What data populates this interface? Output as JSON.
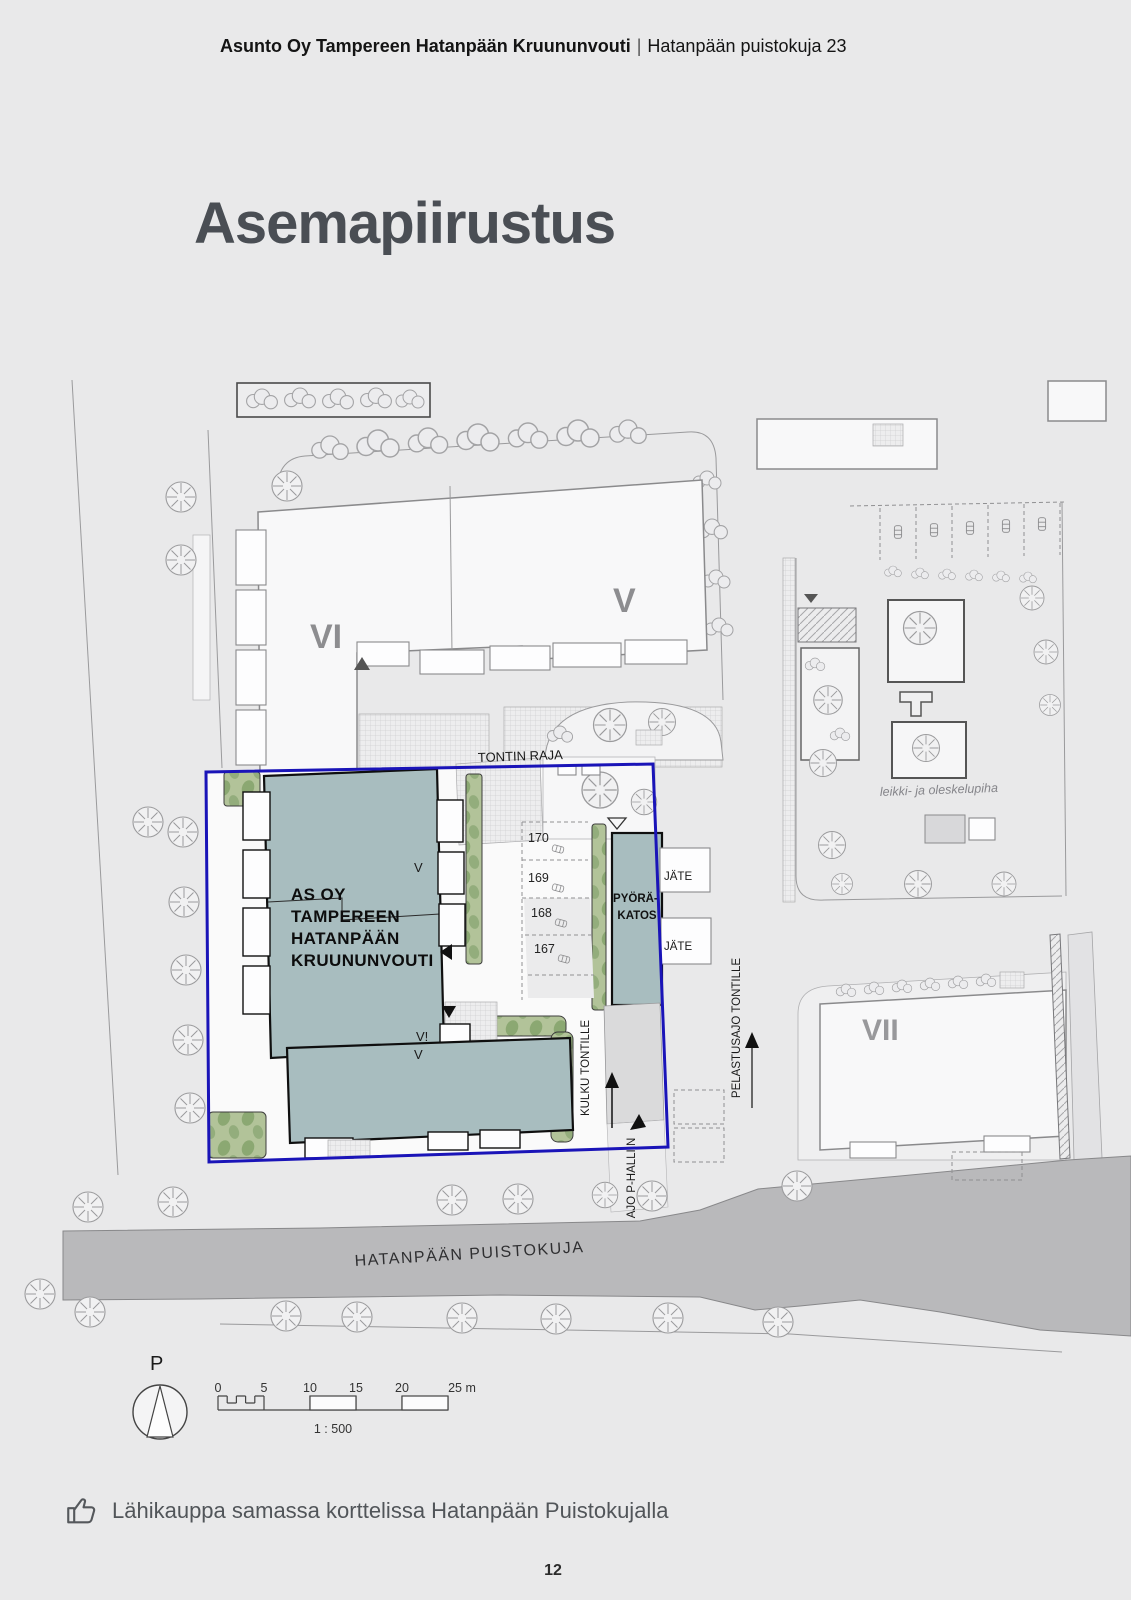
{
  "header": {
    "project": "Asunto Oy Tampereen Hatanpään Kruununvouti",
    "separator": "|",
    "address": "Hatanpään puistokuja 23"
  },
  "title": "Asemapiirustus",
  "plan": {
    "plot_boundary_label": "TONTIN RAJA",
    "blocks": {
      "vi": "VI",
      "v": "V",
      "vii": "VII"
    },
    "main_building": {
      "lines": [
        "AS OY",
        "TAMPEREEN",
        "HATANPÄÄN",
        "KRUUNUNVOUTI"
      ],
      "storey_top": "V",
      "storey_left": "V!",
      "storey_bottom": "V"
    },
    "bike_shelter": {
      "lines": [
        "PYÖRÄ-",
        "KATOS"
      ]
    },
    "waste_label": "JÄTE",
    "parking_numbers": [
      "170",
      "169",
      "168",
      "167"
    ],
    "access": {
      "kulku": "KULKU TONTILLE",
      "ajo": "AJO P-HALLIIN",
      "pelastus": "PELASTUSAJO TONTILLE"
    },
    "yard_label": "leikki- ja oleskelupiha",
    "street": "HATANPÄÄN PUISTOKUJA",
    "north": "P",
    "scale": {
      "ticks": [
        "0",
        "5",
        "10",
        "15",
        "20",
        "25 m"
      ],
      "ratio": "1 : 500"
    },
    "colors": {
      "building_teal": "#a8bdbf",
      "boundary_blue": "#1a14b8",
      "greenery": "#aabf90",
      "road": "#b9b9bb",
      "page_bg": "#e9e9ea"
    }
  },
  "footer": {
    "icon": "thumbs-up",
    "note": "Lähikauppa samassa korttelissa Hatanpään Puistokujalla"
  },
  "page_number": "12"
}
